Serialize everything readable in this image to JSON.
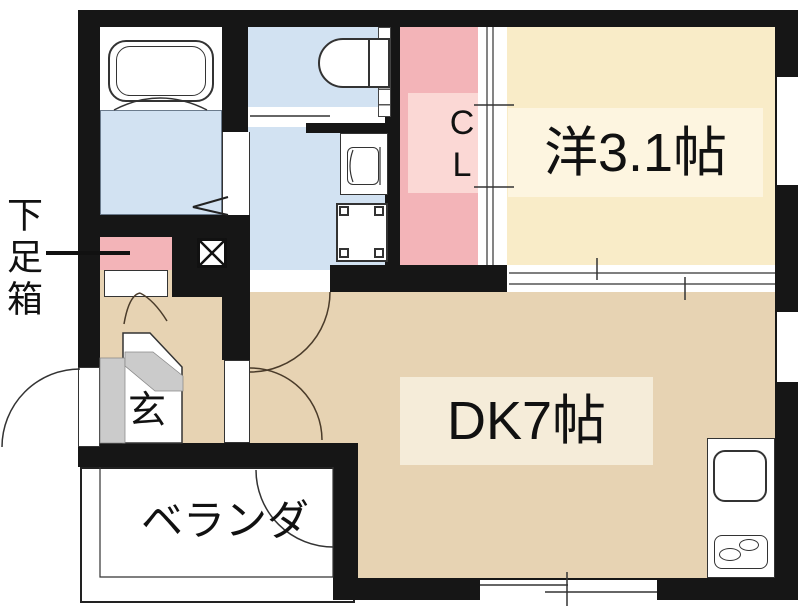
{
  "plan_title": "1DK apartment floor plan",
  "labels": {
    "shoe_box": "下足箱",
    "entrance": "玄",
    "veranda": "ベランダ",
    "closet": "CL",
    "western_room": "洋3.1帖",
    "dining_kitchen": "DK7帖"
  },
  "rooms": [
    {
      "name": "bathroom",
      "fixtures": [
        "bathtub"
      ],
      "floor_color": "#ffffff"
    },
    {
      "name": "washroom",
      "fixtures": [
        "washbasin",
        "washing-machine-pan"
      ],
      "floor_color": "#d2e2f2"
    },
    {
      "name": "toilet-room",
      "fixtures": [
        "toilet"
      ],
      "floor_color": "#d2e2f2"
    },
    {
      "name": "closet",
      "label": "CL",
      "floor_color": "#f3b4b8"
    },
    {
      "name": "western-room",
      "label": "洋3.1帖",
      "size_tatami": 3.1,
      "floor_color": "#f9ecc8"
    },
    {
      "name": "dining-kitchen",
      "label": "DK7帖",
      "size_tatami": 7,
      "fixtures": [
        "kitchen-sink",
        "two-burner-stove"
      ],
      "floor_color": "#e7d3b3"
    },
    {
      "name": "entrance-genkan",
      "label": "玄",
      "floor_color": "#ffffff"
    },
    {
      "name": "veranda",
      "label": "ベランダ",
      "floor_color": "#ffffff"
    },
    {
      "name": "shoe-box",
      "label": "下足箱",
      "color": "#f3b4b8"
    }
  ],
  "symbols": [
    "door-swing-arcs",
    "sliding-door-tracks",
    "pipe-space-x-box",
    "double-door-shoe-box",
    "windows"
  ],
  "colors": {
    "wall": "#161616",
    "tan": "#e7d3b3",
    "tan_light": "#f5ecd9",
    "cream": "#f9ecc8",
    "cream_light": "#fdf5e0",
    "blue": "#d2e2f2",
    "pink": "#f3b4b8",
    "pink_light": "#fbd8d5",
    "gray_step": "#cbcbcb",
    "line": "#3a3a3a",
    "white": "#ffffff"
  }
}
